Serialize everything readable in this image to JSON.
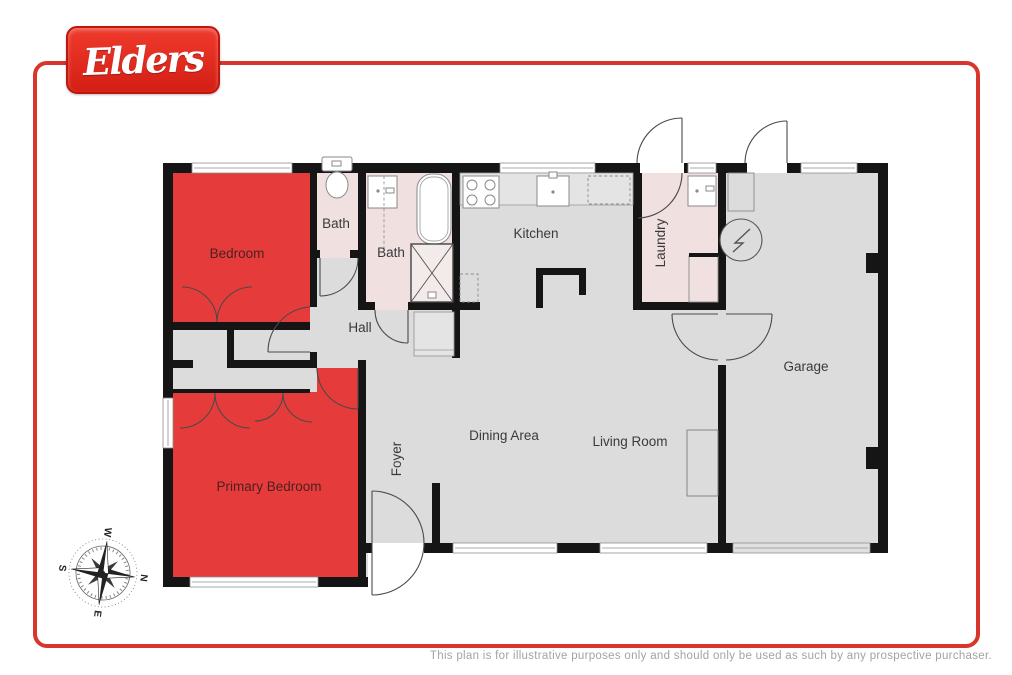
{
  "page": {
    "logo_text": "Elders",
    "disclaimer": "This plan is for illustrative purposes only and should only be used as such by any prospective purchaser.",
    "border_color": "#d8352c",
    "logo_color": "#e2231a"
  },
  "floorplan": {
    "colors": {
      "highlight_room": "#e63b3b",
      "bath_room": "#f0e0e0",
      "floor": "#dcdcdc",
      "wall": "#151515"
    },
    "rooms": [
      {
        "id": "bedroom",
        "label": "Bedroom"
      },
      {
        "id": "bath1",
        "label": "Bath"
      },
      {
        "id": "bath2",
        "label": "Bath"
      },
      {
        "id": "hall",
        "label": "Hall"
      },
      {
        "id": "kitchen",
        "label": "Kitchen"
      },
      {
        "id": "laundry",
        "label": "Laundry"
      },
      {
        "id": "garage",
        "label": "Garage"
      },
      {
        "id": "dining",
        "label": "Dining Area"
      },
      {
        "id": "living",
        "label": "Living Room"
      },
      {
        "id": "foyer",
        "label": "Foyer"
      },
      {
        "id": "primary_bedroom",
        "label": "Primary Bedroom"
      }
    ],
    "compass": {
      "north": "N",
      "east": "E",
      "south": "S",
      "west": "W"
    }
  }
}
